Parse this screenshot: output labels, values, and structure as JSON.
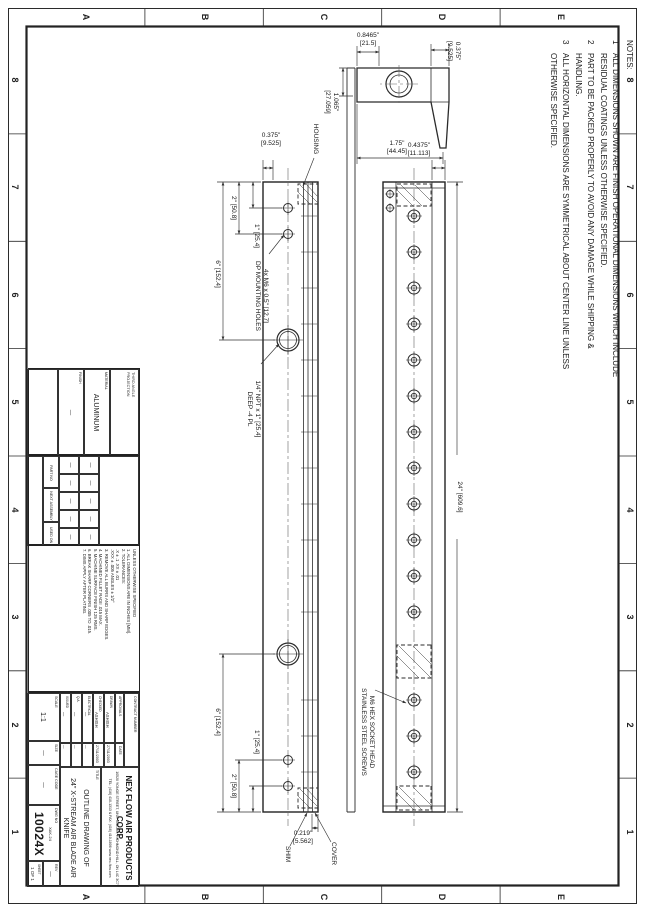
{
  "zones": {
    "cols": [
      "8",
      "7",
      "6",
      "5",
      "4",
      "3",
      "2",
      "1"
    ],
    "rows": [
      "E",
      "D",
      "C",
      "B",
      "A"
    ]
  },
  "notes": {
    "title": "NOTES:",
    "items": [
      {
        "num": "1",
        "text": "ALL DIMENSIONS SHOWN ARE FINISH OPERATIONAL DIMENSIONS WHICH INCLUDE RESIDUAL COATINGS UNLESS OTHERWISE SPECIFIED."
      },
      {
        "num": "2",
        "text": "PART TO BE PACKED PROPERLY TO AVOID ANY DAMAGE WHILE SHIPPING & HANDLING."
      },
      {
        "num": "3",
        "text": "ALL HORIZONTAL DIMENSIONS ARE SYMMETRICAL ABOUT CENTER LINE UNLESS OTHERWISE SPECIFIED."
      }
    ]
  },
  "dims": {
    "end_width_top": "0.375\"\n[9.525]",
    "end_height_left": "0.8465\"\n[21.5]",
    "end_height_right": "1.75\"\n[44.45]",
    "end_width_bottom": "1.065\"\n[27.059]",
    "front_offset": "0.4375\"\n[11.113]",
    "overall_length": "24\" [609.6]",
    "side_thickness": "0.375\"\n[9.525]",
    "hole1_left": "1\" [25.4]",
    "hole2_left": "2\" [50.8]",
    "port_left": "6\" [152.4]",
    "hole1_right": "1\" [25.4]",
    "hole2_right": "2\" [50.8]",
    "port_right": "6\" [152.4]",
    "shim_stack": "0.219\"\n[5.562]"
  },
  "labels": {
    "housing": "HOUSING",
    "shim": "SHIM",
    "cover": "COVER",
    "mounting_holes": "4x M6 x 0.5\" [12.7]\nDP MOUNTING HOLES",
    "npt_ports": "1/4\" NPT x 1\" [25.4]\nDEEP -4 PL",
    "screws": "M6 HEX SOCKET HEAD\nSTAINLESS STEEL SCREWS"
  },
  "projection": {
    "label": "THIRD ANGLE\nPROJECTION"
  },
  "material": {
    "label": "MATERIAL",
    "value": "ALUMINUM"
  },
  "finish": {
    "label": "FINISH",
    "value": "—"
  },
  "application": {
    "part_no": "PART NO",
    "next_assembly": "NEXT ASSEMBLY",
    "used_on": "USED ON",
    "dash": "—"
  },
  "tolerances": {
    "text": "UNLESS OTHERWISE SPECIFIED\n1. ALL DIMENSIONS ARE IN INCHES [MM].\n2. TOLERANCES:\n    .X ± .1       .XX ± .01\n    .XXX ± .005    ANGLES ± 1/2°\n3. REMOVE ALL BURRS AND SHARP EDGES.\n4. MACHINED FILLET RADII .015 MAX.\n5. MACHINE SURFACE FINISH 125 RMS.\n6. BREAK SHARP CORNERS .005 TO .015.\n7. DIMS APPLY AFTER PLATING."
  },
  "title_block": {
    "contract_label": "CONTRACT NUMBER",
    "approvals_header": "APPROVALS",
    "date_header": "DATE",
    "rows": [
      {
        "label": "DRAWN",
        "name": "ASHISH",
        "date": "27/11/2003"
      },
      {
        "label": "CHECKED",
        "name": "ASHISH",
        "date": "27/11/2003"
      },
      {
        "label": "ELECTRICAL",
        "name": "—",
        "date": "—"
      },
      {
        "label": "Q.A.",
        "name": "—",
        "date": "—"
      },
      {
        "label": "ISSUED",
        "name": "—",
        "date": "—"
      }
    ],
    "company": "NEX FLOW AIR PRODUCTS CORP.",
    "address": "10520 YONGE STREET, UNIT 35B-220, RICHMOND HILL, ON L4C 3C7",
    "contact": "TEL: (416) 410-1313 & FAX: (416) 410-1806   www.nex-flow.com",
    "title_label": "TITLE",
    "title_line1": "OUTLINE DRAWING OF",
    "title_line2": "24\" X-STREAM AIR BLADE AIR KNIFE",
    "scale_label": "SCALE",
    "scale_value": "1:1",
    "size_label": "SIZE",
    "size_value": "—",
    "cage_label": "CAGE CODE",
    "cage_value": "—",
    "dwg_label": "DWG NO",
    "model": "XAK-24",
    "dwg_number": "10024X",
    "rev_label": "REV",
    "rev_value": "—",
    "sheet_label": "SHEET",
    "sheet_value": "1 OF 1"
  }
}
